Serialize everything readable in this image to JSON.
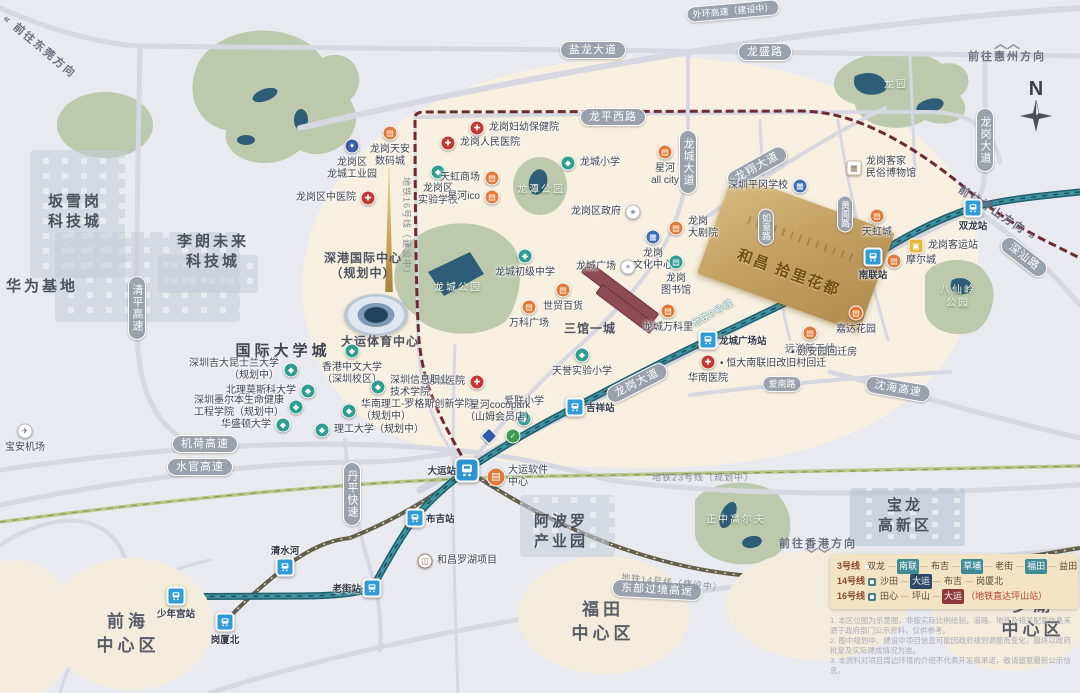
{
  "property": {
    "name": "和昌·拾里花都",
    "display": "和昌 拾里花都",
    "accent_color": "#c3a163"
  },
  "compass": {
    "letter": "N"
  },
  "colors": {
    "metro_line3": "#2a7585",
    "metro_line14": "#645e4b",
    "metro_line16_planned": "#6d2a33",
    "metro_line23_planned": "#b9c78b",
    "poi_commerce": "#e07a36",
    "poi_hospital": "#c13a31",
    "poi_school": "#2f9e92",
    "map_beige": "#f7efe0"
  },
  "roads": [
    {
      "label": "盐龙大道",
      "x": 593,
      "y": 50,
      "rot": 0,
      "v": false,
      "small": false
    },
    {
      "label": "龙盛路",
      "x": 765,
      "y": 52,
      "rot": 0,
      "v": false,
      "small": false
    },
    {
      "label": "外环高速（建设中）",
      "x": 733,
      "y": 11,
      "rot": -5,
      "v": false,
      "small": true
    },
    {
      "label": "龙平西路",
      "x": 613,
      "y": 117,
      "rot": 0,
      "v": false,
      "small": false
    },
    {
      "label": "龙城大道",
      "x": 688,
      "y": 162,
      "rot": 0,
      "v": true,
      "small": false
    },
    {
      "label": "龙翔大道",
      "x": 757,
      "y": 167,
      "rot": -29,
      "v": false,
      "small": false
    },
    {
      "label": "龙岗大道",
      "x": 985,
      "y": 140,
      "rot": 0,
      "v": true,
      "small": false
    },
    {
      "label": "龙岗大道",
      "x": 637,
      "y": 383,
      "rot": -27,
      "v": false,
      "small": false
    },
    {
      "label": "深汕路",
      "x": 1024,
      "y": 257,
      "rot": 38,
      "v": false,
      "small": false
    },
    {
      "label": "如意路",
      "x": 766,
      "y": 227,
      "rot": 0,
      "v": true,
      "small": true
    },
    {
      "label": "黄阁路",
      "x": 845,
      "y": 214,
      "rot": 0,
      "v": true,
      "small": true
    },
    {
      "label": "爱南路",
      "x": 782,
      "y": 384,
      "rot": 0,
      "v": false,
      "small": true
    },
    {
      "label": "沈海高速",
      "x": 898,
      "y": 389,
      "rot": 10,
      "v": false,
      "small": false
    },
    {
      "label": "机荷高速",
      "x": 205,
      "y": 444,
      "rot": 0,
      "v": false,
      "small": false
    },
    {
      "label": "水官高速",
      "x": 200,
      "y": 467,
      "rot": 0,
      "v": false,
      "small": false
    },
    {
      "label": "清平高速",
      "x": 137,
      "y": 308,
      "rot": 0,
      "v": true,
      "small": false
    },
    {
      "label": "丹平快速",
      "x": 352,
      "y": 494,
      "rot": 0,
      "v": true,
      "small": false
    },
    {
      "label": "东部过境高速",
      "x": 657,
      "y": 590,
      "rot": 3,
      "v": false,
      "small": false
    }
  ],
  "metro_labels": [
    {
      "label": "地铁3号线",
      "x": 712,
      "y": 313,
      "rot": -29,
      "online": true
    },
    {
      "label": "地铁16号线（建设中）",
      "x": 407,
      "y": 228,
      "rot": 90,
      "online": false
    },
    {
      "label": "地铁23号线（规划中）",
      "x": 703,
      "y": 477,
      "rot": 0,
      "online": false
    },
    {
      "label": "地铁14号线（建设中）",
      "x": 672,
      "y": 582,
      "rot": 6,
      "online": false
    }
  ],
  "directions": [
    {
      "label": "前往惠州方向",
      "x": 1007,
      "y": 52,
      "rot": 0,
      "chev": "up"
    },
    {
      "label": "前往坪山方向 »",
      "x": 998,
      "y": 213,
      "rot": 33,
      "chev": "none"
    },
    {
      "label": "前往香港方向",
      "x": 818,
      "y": 547,
      "rot": 0,
      "chev": "down"
    },
    {
      "label": "« 前往东莞方向",
      "x": 40,
      "y": 46,
      "rot": 40,
      "chev": "none"
    }
  ],
  "stations": [
    {
      "label": "双龙站",
      "x": 973,
      "y": 208,
      "side": "below",
      "big": false
    },
    {
      "label": "南联站",
      "x": 873,
      "y": 257,
      "side": "below",
      "big": false
    },
    {
      "label": "龙城广场站",
      "x": 708,
      "y": 340,
      "side": "right",
      "big": false
    },
    {
      "label": "吉祥站",
      "x": 575,
      "y": 407,
      "side": "right",
      "big": false
    },
    {
      "label": "大运站",
      "x": 467,
      "y": 470,
      "side": "left",
      "big": true
    },
    {
      "label": "布吉站",
      "x": 415,
      "y": 518,
      "side": "right",
      "big": false
    },
    {
      "label": "老街站",
      "x": 372,
      "y": 588,
      "side": "left",
      "big": false
    },
    {
      "label": "少年宫站",
      "x": 176,
      "y": 596,
      "side": "below",
      "big": false
    },
    {
      "label": "清水河",
      "x": 285,
      "y": 567,
      "side": "above",
      "big": false
    },
    {
      "label": "岗厦北",
      "x": 225,
      "y": 622,
      "side": "below",
      "big": false
    }
  ],
  "areas": [
    {
      "lines": [
        "坂雪岗",
        "科技城"
      ],
      "x": 75,
      "y": 212,
      "cls": "big"
    },
    {
      "lines": [
        "华为基地"
      ],
      "x": 42,
      "y": 287,
      "cls": "big"
    },
    {
      "lines": [
        "李朗未来",
        "科技城"
      ],
      "x": 213,
      "y": 252,
      "cls": "big"
    },
    {
      "lines": [
        "国际大学城"
      ],
      "x": 283,
      "y": 350,
      "cls": "uni"
    },
    {
      "lines": [
        "深港国际中心",
        "（规划中）"
      ],
      "x": 363,
      "y": 266,
      "cls": "mid"
    },
    {
      "lines": [
        "大运体育中心"
      ],
      "x": 380,
      "y": 342,
      "cls": "mid"
    },
    {
      "lines": [
        "三馆一城"
      ],
      "x": 590,
      "y": 329,
      "cls": "mid"
    },
    {
      "lines": [
        "阿波罗",
        "产业园"
      ],
      "x": 561,
      "y": 532,
      "cls": "big"
    },
    {
      "lines": [
        "宝龙",
        "高新区"
      ],
      "x": 905,
      "y": 516,
      "cls": "big"
    },
    {
      "lines": [
        "前海",
        "中心区"
      ],
      "x": 128,
      "y": 634,
      "cls": "district"
    },
    {
      "lines": [
        "福田",
        "中心区"
      ],
      "x": 603,
      "y": 622,
      "cls": "district"
    },
    {
      "lines": [
        "罗湖",
        "中心区"
      ],
      "x": 1033,
      "y": 618,
      "cls": "district"
    }
  ],
  "parks": [
    {
      "lines": [
        "龙园"
      ],
      "x": 896,
      "y": 85
    },
    {
      "lines": [
        "龙潭公园"
      ],
      "x": 541,
      "y": 190
    },
    {
      "lines": [
        "龙城公园"
      ],
      "x": 458,
      "y": 288
    },
    {
      "lines": [
        "八仙岭",
        "公园"
      ],
      "x": 958,
      "y": 297
    },
    {
      "lines": [
        "正中高尔夫"
      ],
      "x": 736,
      "y": 520
    }
  ],
  "pois": [
    {
      "t": "industry",
      "lines": [
        "龙岗区",
        "龙城工业园"
      ],
      "x": 352,
      "y": 146,
      "side": "below"
    },
    {
      "t": "mall",
      "lines": [
        "龙岗天安",
        "数码城"
      ],
      "x": 390,
      "y": 133,
      "side": "below"
    },
    {
      "t": "hospital",
      "lines": [
        "龙岗区中医院"
      ],
      "x": 368,
      "y": 198,
      "side": "left"
    },
    {
      "t": "hospital",
      "lines": [
        "龙岗人民医院"
      ],
      "x": 448,
      "y": 143,
      "side": "right"
    },
    {
      "t": "hospital",
      "lines": [
        "龙岗妇幼保健院"
      ],
      "x": 477,
      "y": 128,
      "side": "right"
    },
    {
      "t": "school",
      "lines": [
        "龙岗区",
        "实验学校"
      ],
      "x": 438,
      "y": 172,
      "side": "below"
    },
    {
      "t": "mall",
      "lines": [
        "天虹商场"
      ],
      "x": 492,
      "y": 178,
      "side": "left"
    },
    {
      "t": "mall",
      "lines": [
        "星河ico"
      ],
      "x": 492,
      "y": 197,
      "side": "left"
    },
    {
      "t": "school",
      "lines": [
        "龙城小学"
      ],
      "x": 568,
      "y": 163,
      "side": "right"
    },
    {
      "t": "mall",
      "lines": [
        "星河",
        "all city"
      ],
      "x": 665,
      "y": 152,
      "side": "below"
    },
    {
      "t": "gov",
      "lines": [
        "龙岗区政府"
      ],
      "x": 633,
      "y": 212,
      "side": "left"
    },
    {
      "t": "culture",
      "lines": [
        "龙岗",
        "文化中心"
      ],
      "x": 653,
      "y": 237,
      "side": "below"
    },
    {
      "t": "mall",
      "lines": [
        "龙岗",
        "大剧院"
      ],
      "x": 676,
      "y": 228,
      "side": "right"
    },
    {
      "t": "library",
      "lines": [
        "龙岗",
        "图书馆"
      ],
      "x": 676,
      "y": 262,
      "side": "below"
    },
    {
      "t": "plaza",
      "lines": [
        "龙城广场"
      ],
      "x": 628,
      "y": 267,
      "side": "left"
    },
    {
      "t": "school",
      "lines": [
        "龙城初级中学"
      ],
      "x": 525,
      "y": 256,
      "side": "below"
    },
    {
      "t": "mall",
      "lines": [
        "世贸百货"
      ],
      "x": 563,
      "y": 290,
      "side": "below"
    },
    {
      "t": "mall",
      "lines": [
        "龙城万科里"
      ],
      "x": 668,
      "y": 311,
      "side": "below"
    },
    {
      "t": "mall",
      "lines": [
        "万科广场"
      ],
      "x": 529,
      "y": 307,
      "side": "below"
    },
    {
      "t": "school",
      "lines": [
        "天誉实验小学"
      ],
      "x": 582,
      "y": 355,
      "side": "below"
    },
    {
      "t": "hospital",
      "lines": [
        "龙城医院"
      ],
      "x": 477,
      "y": 382,
      "side": "left"
    },
    {
      "t": "school",
      "lines": [
        "爱联小学"
      ],
      "x": 524,
      "y": 419,
      "side": "above"
    },
    {
      "t": "hospital",
      "lines": [
        "华南医院"
      ],
      "x": 708,
      "y": 362,
      "side": "below"
    },
    {
      "t": "mall",
      "lines": [
        "远洋新干线"
      ],
      "x": 810,
      "y": 333,
      "side": "below"
    },
    {
      "t": "mall",
      "lines": [
        "嘉达花园"
      ],
      "x": 856,
      "y": 313,
      "side": "below"
    },
    {
      "t": "culture",
      "lines": [
        "深圳平冈学校"
      ],
      "x": 800,
      "y": 186,
      "side": "left"
    },
    {
      "t": "museum",
      "lines": [
        "龙岗客家",
        "民俗博物馆"
      ],
      "x": 854,
      "y": 168,
      "side": "right"
    },
    {
      "t": "mall",
      "lines": [
        "天虹城"
      ],
      "x": 877,
      "y": 216,
      "side": "below"
    },
    {
      "t": "bus",
      "lines": [
        "龙岗客运站"
      ],
      "x": 916,
      "y": 246,
      "side": "right"
    },
    {
      "t": "mall",
      "lines": [
        "摩尔城"
      ],
      "x": 894,
      "y": 261,
      "side": "right"
    },
    {
      "t": "hechang",
      "lines": [
        "和昌罗湖项目"
      ],
      "x": 425,
      "y": 561,
      "side": "right"
    },
    {
      "t": "airport",
      "lines": [
        "宝安机场"
      ],
      "x": 25,
      "y": 431,
      "side": "below"
    },
    {
      "t": "mall-lg",
      "lines": [
        "大运软件",
        "中心"
      ],
      "x": 496,
      "y": 477,
      "side": "right"
    },
    {
      "t": "sam",
      "lines": [],
      "x": 489,
      "y": 436,
      "side": "below"
    },
    {
      "t": "coco",
      "lines": [],
      "x": 513,
      "y": 436,
      "side": "below"
    },
    {
      "t": "school",
      "lines": [
        "香港中文大学",
        "（深圳校区）"
      ],
      "x": 352,
      "y": 351,
      "side": "below"
    },
    {
      "t": "school",
      "lines": [
        "深圳吉大昆士兰大学",
        "（规划中）"
      ],
      "x": 291,
      "y": 370,
      "side": "left"
    },
    {
      "t": "school",
      "lines": [
        "北理莫斯科大学"
      ],
      "x": 308,
      "y": 391,
      "side": "left"
    },
    {
      "t": "school",
      "lines": [
        "深圳信息职业",
        "技术学院"
      ],
      "x": 378,
      "y": 387,
      "side": "right"
    },
    {
      "t": "school",
      "lines": [
        "深圳墨尔本生命健康",
        "工程学院（规划中）"
      ],
      "x": 296,
      "y": 407,
      "side": "left"
    },
    {
      "t": "school",
      "lines": [
        "华南理工-罗格斯创新学院",
        "（规划中）"
      ],
      "x": 349,
      "y": 411,
      "side": "right"
    },
    {
      "t": "school",
      "lines": [
        "华盛顿大学"
      ],
      "x": 283,
      "y": 425,
      "side": "left"
    },
    {
      "t": "school",
      "lines": [
        "理工大学（规划中）"
      ],
      "x": 322,
      "y": 430,
      "side": "right"
    }
  ],
  "plain_labels": [
    {
      "lines": [
        "星河cocopark",
        "（山姆会员店）"
      ],
      "x": 500,
      "y": 412,
      "center": true
    },
    {
      "lines": [
        "• 恒大南联旧改旧村回迁"
      ],
      "x": 720,
      "y": 364,
      "center": false
    },
    {
      "lines": [
        "• 颐安园回迁房"
      ],
      "x": 791,
      "y": 353,
      "center": false
    }
  ],
  "legend": {
    "rows": [
      {
        "line": "3号线",
        "stations": [
          {
            "n": "双龙",
            "hl": ""
          },
          {
            "n": "南联",
            "hl": "teal"
          },
          {
            "n": "布吉",
            "hl": ""
          },
          {
            "n": "草埔",
            "hl": "teal"
          },
          {
            "n": "老街",
            "hl": ""
          },
          {
            "n": "福田",
            "hl": "teal"
          },
          {
            "n": "益田",
            "hl": ""
          }
        ],
        "suffix": ""
      },
      {
        "line": "14号线",
        "stations": [
          {
            "n": "沙田",
            "hl": ""
          },
          {
            "n": "大运",
            "hl": "navy"
          },
          {
            "n": "布吉",
            "hl": ""
          },
          {
            "n": "岗厦北",
            "hl": ""
          }
        ],
        "suffix": ""
      },
      {
        "line": "16号线",
        "stations": [
          {
            "n": "田心",
            "hl": ""
          },
          {
            "n": "坪山",
            "hl": ""
          },
          {
            "n": "大运",
            "hl": "maroon"
          }
        ],
        "suffix": "（地铁直达坪山站）"
      }
    ]
  },
  "disclaimer": [
    "1. 本区位图为示意图，非按实际比例绘制，道路、地铁及相关配套信息来源于政府部门公示资料，仅供参考。",
    "2. 图中规划中、建设中项目信息可能因政府规划调整而变化，最终以政府批复及实际建成情况为准。",
    "3. 本资料对项目周边环境的介绍不代表开发商承诺，敬请留意最新公示信息。"
  ]
}
